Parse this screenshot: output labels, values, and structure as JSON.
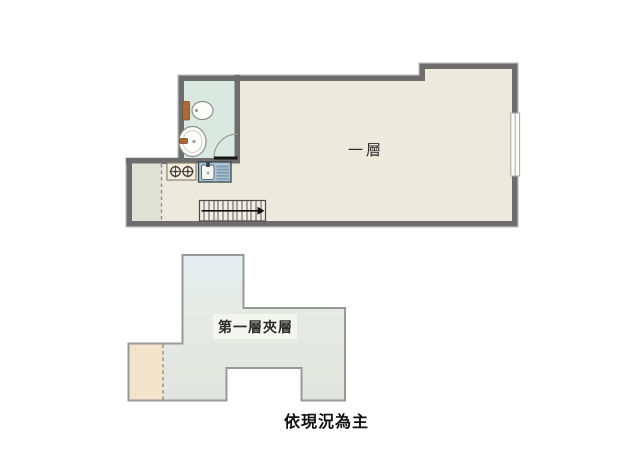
{
  "floor1": {
    "label": "一層",
    "fixtures": [
      "toilet-icon",
      "washbasin-icon",
      "door-swing-icon",
      "stove-icon",
      "kitchen-sink-icon",
      "staircase-icon",
      "window-icon"
    ]
  },
  "mezzanine": {
    "label": "第一層夾層"
  },
  "footnote": {
    "text": "依現況為主"
  },
  "colors": {
    "wall": "#6d6d6d",
    "wall_halo": "#c0c0c0",
    "floor": "#ece9dd",
    "bathroom": "#d9e8e1",
    "annex": "#e1e2d6",
    "mezz_top": "#e3ecef",
    "mezz_mid": "#e7ebe6",
    "mezz_bottom": "#e2e5df",
    "mezz_outline": "#97999b",
    "tan": "#f3e4cb",
    "brown": "#a8693b",
    "sink_blue": "#aec3d2",
    "sink_stripe": "#7d9cb4",
    "stove": "#f6eedd",
    "stairs": "#f0ede3",
    "text": "#2c2c2c"
  }
}
